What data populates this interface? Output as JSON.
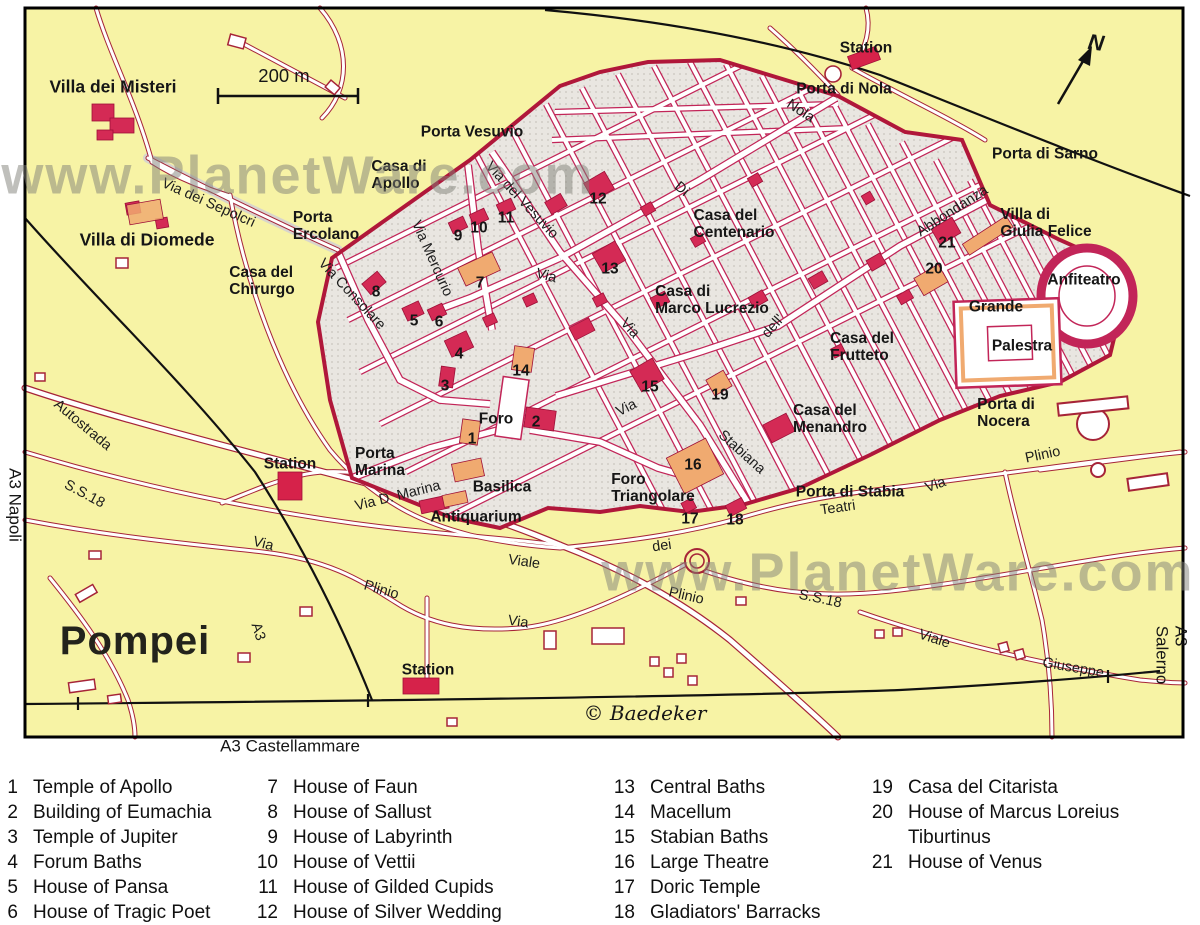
{
  "map": {
    "colors": {
      "background_yellow": "#f7f3a5",
      "city_fill": "#e9e6e1",
      "block_outline": "#c22558",
      "wall_red": "#b0173a",
      "building_red": "#d42a55",
      "building_orange": "#f0aa70",
      "road_casing": "#a62438",
      "railway_black": "#111111",
      "watermark_gray": "#80807a"
    },
    "labels": [
      {
        "t": "Villa dei Misteri",
        "x": 113,
        "y": 87,
        "r": 0,
        "c": "place-lg"
      },
      {
        "t": "Villa di Diomede",
        "x": 147,
        "y": 240,
        "r": 0,
        "c": "place-lg"
      },
      {
        "t": "Casa del\nChirurgo",
        "x": 262,
        "y": 281,
        "r": 0,
        "c": "place"
      },
      {
        "t": "Porta\nErcolano",
        "x": 326,
        "y": 226,
        "r": 0,
        "c": "place"
      },
      {
        "t": "Casa di\nApollo",
        "x": 399,
        "y": 175,
        "r": 0,
        "c": "place"
      },
      {
        "t": "Porta Vesuvio",
        "x": 472,
        "y": 132,
        "r": 0,
        "c": "place"
      },
      {
        "t": "Station",
        "x": 866,
        "y": 48,
        "r": 0,
        "c": "place"
      },
      {
        "t": "Porta di Nola",
        "x": 844,
        "y": 89,
        "r": 0,
        "c": "place"
      },
      {
        "t": "Porta di Sarno",
        "x": 1045,
        "y": 154,
        "r": 0,
        "c": "place"
      },
      {
        "t": "Villa di\nGiulia Felice",
        "x": 1046,
        "y": 223,
        "r": 0,
        "c": "place"
      },
      {
        "t": "Casa del\nCentenario",
        "x": 734,
        "y": 224,
        "r": 0,
        "c": "place"
      },
      {
        "t": "Casa di\nMarco Lucrezio",
        "x": 712,
        "y": 300,
        "r": 0,
        "c": "place"
      },
      {
        "t": "Casa del\nFrutteto",
        "x": 862,
        "y": 347,
        "r": 0,
        "c": "place"
      },
      {
        "t": "Casa del\nMenandro",
        "x": 830,
        "y": 419,
        "r": 0,
        "c": "place"
      },
      {
        "t": "Anfiteatro",
        "x": 1084,
        "y": 280,
        "r": 0,
        "c": "place"
      },
      {
        "t": "Grande",
        "x": 996,
        "y": 307,
        "r": 0,
        "c": "place"
      },
      {
        "t": "Palestra",
        "x": 1022,
        "y": 346,
        "r": 0,
        "c": "place"
      },
      {
        "t": "Porta di\nNocera",
        "x": 1006,
        "y": 413,
        "r": 0,
        "c": "place"
      },
      {
        "t": "Porta di Stabia",
        "x": 850,
        "y": 492,
        "r": 0,
        "c": "place"
      },
      {
        "t": "Foro\nTriangolare",
        "x": 653,
        "y": 488,
        "r": 0,
        "c": "place"
      },
      {
        "t": "Foro",
        "x": 496,
        "y": 419,
        "r": 0,
        "c": "place"
      },
      {
        "t": "Basilica",
        "x": 502,
        "y": 487,
        "r": 0,
        "c": "place"
      },
      {
        "t": "Antiquarium",
        "x": 476,
        "y": 517,
        "r": 0,
        "c": "place"
      },
      {
        "t": "Porta\nMarina",
        "x": 380,
        "y": 462,
        "r": 0,
        "c": "place"
      },
      {
        "t": "Station",
        "x": 290,
        "y": 464,
        "r": 0,
        "c": "place"
      },
      {
        "t": "Station",
        "x": 428,
        "y": 670,
        "r": 0,
        "c": "place"
      },
      {
        "t": "Via dei Sepolcri",
        "x": 208,
        "y": 204,
        "r": 24,
        "c": "street"
      },
      {
        "t": "Via Consolare",
        "x": 351,
        "y": 295,
        "r": 47,
        "c": "street"
      },
      {
        "t": "Via Mercurio",
        "x": 431,
        "y": 259,
        "r": 66,
        "c": "street"
      },
      {
        "t": "Via del Vesuvio",
        "x": 521,
        "y": 201,
        "r": 47,
        "c": "street"
      },
      {
        "t": "Via",
        "x": 546,
        "y": 277,
        "r": 14,
        "c": "street"
      },
      {
        "t": "Via",
        "x": 629,
        "y": 329,
        "r": 48,
        "c": "street"
      },
      {
        "t": "Stabiana",
        "x": 741,
        "y": 453,
        "r": 42,
        "c": "street"
      },
      {
        "t": "Via",
        "x": 627,
        "y": 409,
        "r": -27,
        "c": "street"
      },
      {
        "t": "dell'",
        "x": 774,
        "y": 327,
        "r": -48,
        "c": "street"
      },
      {
        "t": "Abbondanza",
        "x": 953,
        "y": 212,
        "r": -33,
        "c": "street"
      },
      {
        "t": "Di",
        "x": 681,
        "y": 190,
        "r": 40,
        "c": "street"
      },
      {
        "t": "Nola",
        "x": 800,
        "y": 112,
        "r": 33,
        "c": "street"
      },
      {
        "t": "Via D. Marina",
        "x": 398,
        "y": 497,
        "r": -14,
        "c": "street"
      },
      {
        "t": "Via",
        "x": 936,
        "y": 486,
        "r": -20,
        "c": "street"
      },
      {
        "t": "Teatri",
        "x": 838,
        "y": 509,
        "r": -8,
        "c": "street"
      },
      {
        "t": "dei",
        "x": 662,
        "y": 547,
        "r": -8,
        "c": "street"
      },
      {
        "t": "Viale",
        "x": 524,
        "y": 563,
        "r": 8,
        "c": "street"
      },
      {
        "t": "Plinio",
        "x": 381,
        "y": 591,
        "r": 16,
        "c": "street"
      },
      {
        "t": "Plinio",
        "x": 686,
        "y": 597,
        "r": 13,
        "c": "street"
      },
      {
        "t": "S.S.18",
        "x": 84,
        "y": 495,
        "r": 28,
        "c": "street"
      },
      {
        "t": "S.S.18",
        "x": 820,
        "y": 600,
        "r": 12,
        "c": "street"
      },
      {
        "t": "Viale",
        "x": 934,
        "y": 640,
        "r": 18,
        "c": "street"
      },
      {
        "t": "Giuseppe",
        "x": 1073,
        "y": 669,
        "r": 10,
        "c": "street"
      },
      {
        "t": "Via",
        "x": 263,
        "y": 545,
        "r": 14,
        "c": "street"
      },
      {
        "t": "Via",
        "x": 518,
        "y": 623,
        "r": 8,
        "c": "street"
      },
      {
        "t": "Autostrada",
        "x": 82,
        "y": 426,
        "r": 40,
        "c": "street"
      },
      {
        "t": "A3",
        "x": 257,
        "y": 632,
        "r": 72,
        "c": "street"
      },
      {
        "t": "Plinio",
        "x": 1043,
        "y": 456,
        "r": -12,
        "c": "street"
      },
      {
        "t": "1",
        "x": 472,
        "y": 439,
        "r": 0,
        "c": "num"
      },
      {
        "t": "2",
        "x": 536,
        "y": 422,
        "r": 0,
        "c": "num"
      },
      {
        "t": "3",
        "x": 445,
        "y": 386,
        "r": 0,
        "c": "num"
      },
      {
        "t": "4",
        "x": 459,
        "y": 354,
        "r": 0,
        "c": "num"
      },
      {
        "t": "5",
        "x": 414,
        "y": 321,
        "r": 0,
        "c": "num"
      },
      {
        "t": "6",
        "x": 439,
        "y": 322,
        "r": 0,
        "c": "num"
      },
      {
        "t": "7",
        "x": 480,
        "y": 283,
        "r": 0,
        "c": "num"
      },
      {
        "t": "8",
        "x": 376,
        "y": 292,
        "r": 0,
        "c": "num"
      },
      {
        "t": "9",
        "x": 458,
        "y": 236,
        "r": 0,
        "c": "num"
      },
      {
        "t": "10",
        "x": 479,
        "y": 228,
        "r": 0,
        "c": "num"
      },
      {
        "t": "11",
        "x": 506,
        "y": 218,
        "r": 0,
        "c": "num"
      },
      {
        "t": "12",
        "x": 598,
        "y": 199,
        "r": 0,
        "c": "num"
      },
      {
        "t": "13",
        "x": 610,
        "y": 269,
        "r": 0,
        "c": "num"
      },
      {
        "t": "14",
        "x": 521,
        "y": 371,
        "r": 0,
        "c": "num"
      },
      {
        "t": "15",
        "x": 650,
        "y": 387,
        "r": 0,
        "c": "num"
      },
      {
        "t": "16",
        "x": 693,
        "y": 465,
        "r": 0,
        "c": "num"
      },
      {
        "t": "17",
        "x": 690,
        "y": 519,
        "r": 0,
        "c": "num"
      },
      {
        "t": "18",
        "x": 735,
        "y": 520,
        "r": 0,
        "c": "num"
      },
      {
        "t": "19",
        "x": 720,
        "y": 395,
        "r": 0,
        "c": "num"
      },
      {
        "t": "20",
        "x": 934,
        "y": 269,
        "r": 0,
        "c": "num"
      },
      {
        "t": "21",
        "x": 947,
        "y": 243,
        "r": 0,
        "c": "num"
      },
      {
        "t": "Pompei",
        "x": 135,
        "y": 641,
        "r": 0,
        "c": "title"
      },
      {
        "t": "© Baedeker",
        "x": 645,
        "y": 713,
        "r": 0,
        "c": "copyright"
      },
      {
        "t": "A3 Castellammare",
        "x": 290,
        "y": 747,
        "r": 0,
        "c": "ext"
      },
      {
        "t": "200 m",
        "x": 284,
        "y": 76,
        "r": 0,
        "c": "scale-text"
      },
      {
        "t": "A3 Napoli",
        "x": 14,
        "y": 505,
        "r": 90,
        "c": "ext"
      },
      {
        "t": "A3 Salerno",
        "x": 1171,
        "y": 655,
        "r": 90,
        "c": "ext"
      },
      {
        "t": "www.PlanetWare.com",
        "x": 298,
        "y": 176,
        "r": 0,
        "c": "watermark"
      },
      {
        "t": "www.PlanetWare.com",
        "x": 898,
        "y": 573,
        "r": 0,
        "c": "watermark"
      },
      {
        "t": "N",
        "x": 1096,
        "y": 43,
        "r": 8,
        "c": "north"
      }
    ]
  },
  "legend": {
    "columns": [
      {
        "left": 0,
        "numw": 18,
        "items": [
          {
            "num": "1",
            "name": "Temple of Apollo"
          },
          {
            "num": "2",
            "name": "Building of Eumachia"
          },
          {
            "num": "3",
            "name": "Temple of Jupiter"
          },
          {
            "num": "4",
            "name": "Forum Baths"
          },
          {
            "num": "5",
            "name": "House of Pansa"
          },
          {
            "num": "6",
            "name": "House of Tragic Poet"
          }
        ]
      },
      {
        "left": 246,
        "numw": 32,
        "items": [
          {
            "num": "7",
            "name": "House of Faun"
          },
          {
            "num": "8",
            "name": "House of Sallust"
          },
          {
            "num": "9",
            "name": "House of Labyrinth"
          },
          {
            "num": "10",
            "name": "House of Vettii"
          },
          {
            "num": "11",
            "name": "House of Gilded Cupids"
          },
          {
            "num": "12",
            "name": "House of Silver Wedding"
          }
        ]
      },
      {
        "left": 600,
        "numw": 35,
        "items": [
          {
            "num": "13",
            "name": "Central Baths"
          },
          {
            "num": "14",
            "name": "Macellum"
          },
          {
            "num": "15",
            "name": "Stabian Baths"
          },
          {
            "num": "16",
            "name": "Large Theatre"
          },
          {
            "num": "17",
            "name": "Doric Temple"
          },
          {
            "num": "18",
            "name": "Gladiators' Barracks"
          }
        ]
      },
      {
        "left": 860,
        "numw": 33,
        "items": [
          {
            "num": "19",
            "name": "Casa del Citarista"
          },
          {
            "num": "20",
            "name": "House of Marcus Loreius Tiburtinus"
          },
          {
            "num": "21",
            "name": "House of Venus"
          }
        ]
      }
    ]
  }
}
